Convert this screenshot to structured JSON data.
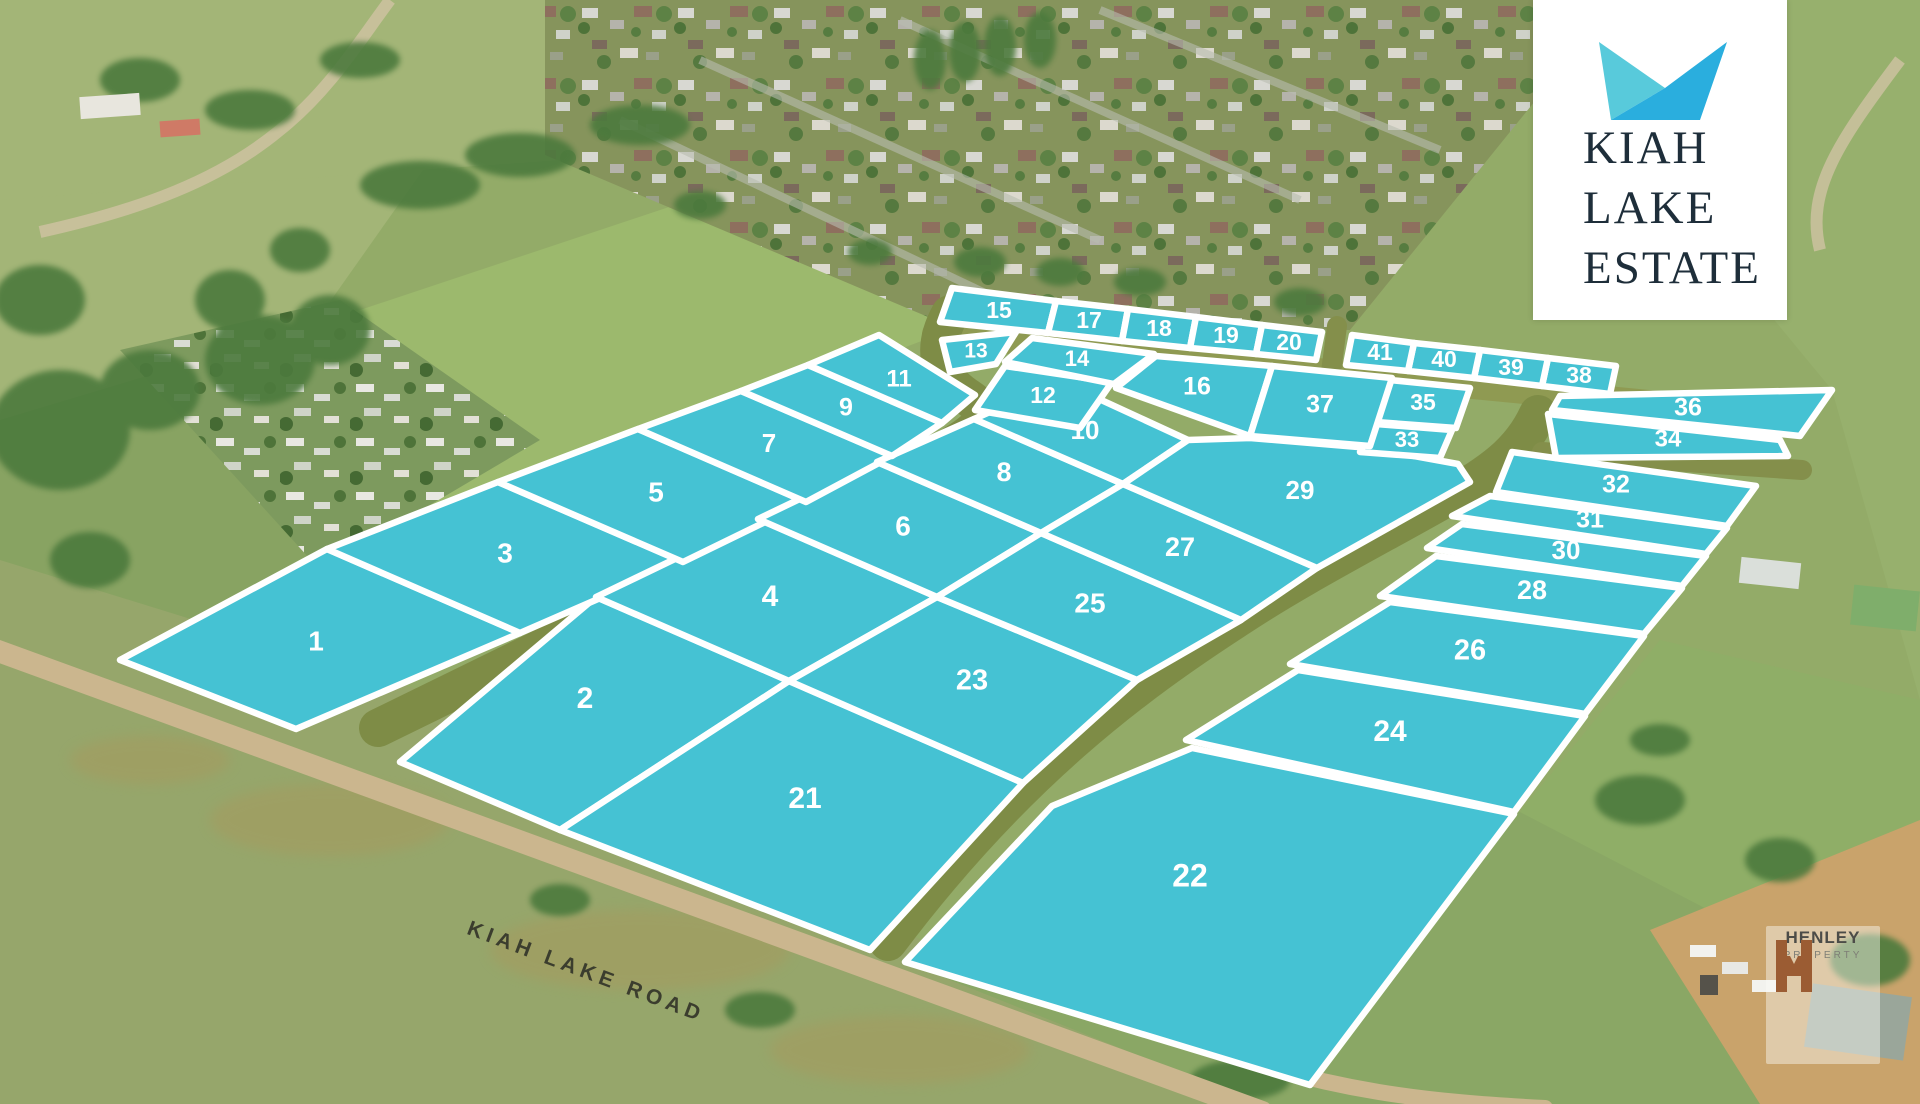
{
  "logo": {
    "line1": "KIAH",
    "line2": "LAKE",
    "line3": "ESTATE"
  },
  "road_label": "KIAH LAKE ROAD",
  "watermark": {
    "monogram": "H",
    "name": "HENLEY",
    "sub": "PROPERTY"
  },
  "colors": {
    "lot_fill": "#45c2d3",
    "lot_border": "#ffffff",
    "road_olive": "#7e8c46",
    "road_olive_light": "#8f9a52",
    "dirt_road": "#cbb68e",
    "logo_teal_light": "#58cadb",
    "logo_blue": "#2aaede",
    "logo_text": "#1e2e3a",
    "watermark_rust": "#9b5c33"
  },
  "map": {
    "lots": [
      {
        "n": "1",
        "points": "120,660 327,549 520,633 296,729",
        "lx": 316,
        "ly": 643,
        "fs": 28
      },
      {
        "n": "2",
        "points": "400,762 596,597 789,681 560,830",
        "lx": 585,
        "ly": 700,
        "fs": 30
      },
      {
        "n": "3",
        "points": "327,549 498,482 683,562 520,633",
        "lx": 505,
        "ly": 555,
        "fs": 28
      },
      {
        "n": "4",
        "points": "596,597 758,519 937,597 789,681",
        "lx": 770,
        "ly": 598,
        "fs": 30
      },
      {
        "n": "5",
        "points": "498,482 638,429 806,502 683,562",
        "lx": 656,
        "ly": 494,
        "fs": 28
      },
      {
        "n": "6",
        "points": "758,519 877,462 1041,533 937,597",
        "lx": 903,
        "ly": 528,
        "fs": 28
      },
      {
        "n": "7",
        "points": "638,429 741,391 892,456 806,502",
        "lx": 769,
        "ly": 445,
        "fs": 26
      },
      {
        "n": "8",
        "points": "877,462 974,419 1123,484 1041,533",
        "lx": 1004,
        "ly": 474,
        "fs": 27
      },
      {
        "n": "9",
        "points": "741,391 808,365 942,423 892,456",
        "lx": 846,
        "ly": 409,
        "fs": 25
      },
      {
        "n": "10",
        "points": "974,419 1060,381 1188,440 1123,484",
        "lx": 1085,
        "ly": 432,
        "fs": 26
      },
      {
        "n": "11",
        "points": "808,365 879,335 975,395 942,423",
        "lx": 899,
        "ly": 380,
        "fs": 24
      },
      {
        "n": "12",
        "points": "975,410 1005,366 1112,382 1080,428",
        "lx": 1043,
        "ly": 397,
        "fs": 23
      },
      {
        "n": "13",
        "points": "942,340 1016,332 996,364 950,372",
        "lx": 976,
        "ly": 352,
        "fs": 21
      },
      {
        "n": "14",
        "points": "1005,362 1032,338 1154,354 1114,384",
        "lx": 1077,
        "ly": 360,
        "fs": 22
      },
      {
        "n": "15",
        "points": "952,288 1056,301 1048,333 940,322",
        "lx": 999,
        "ly": 312,
        "fs": 23
      },
      {
        "n": "16",
        "points": "1156,356 1272,366 1250,436 1116,388",
        "lx": 1197,
        "ly": 388,
        "fs": 25
      },
      {
        "n": "17",
        "points": "1056,301 1128,309 1122,341 1048,333",
        "lx": 1089,
        "ly": 322,
        "fs": 23
      },
      {
        "n": "18",
        "points": "1128,309 1196,317 1190,348 1122,341",
        "lx": 1159,
        "ly": 330,
        "fs": 23
      },
      {
        "n": "19",
        "points": "1196,317 1262,325 1256,354 1190,348",
        "lx": 1226,
        "ly": 337,
        "fs": 23
      },
      {
        "n": "20",
        "points": "1262,325 1322,332 1316,360 1256,354",
        "lx": 1289,
        "ly": 344,
        "fs": 23
      },
      {
        "n": "21",
        "points": "560,830 789,681 1023,783 870,950",
        "lx": 805,
        "ly": 800,
        "fs": 30
      },
      {
        "n": "22",
        "points": "1052,806 1192,748 1514,814 1310,1085 905,962",
        "lx": 1190,
        "ly": 878,
        "fs": 32
      },
      {
        "n": "23",
        "points": "789,681 937,597 1137,680 1023,783",
        "lx": 972,
        "ly": 682,
        "fs": 29
      },
      {
        "n": "24",
        "points": "1298,670 1585,716 1514,812 1186,740",
        "lx": 1390,
        "ly": 733,
        "fs": 30
      },
      {
        "n": "25",
        "points": "937,597 1041,533 1241,620 1137,680",
        "lx": 1090,
        "ly": 605,
        "fs": 28
      },
      {
        "n": "26",
        "points": "1390,602 1644,636 1585,714 1290,664",
        "lx": 1470,
        "ly": 652,
        "fs": 29
      },
      {
        "n": "27",
        "points": "1041,533 1123,484 1317,568 1241,620",
        "lx": 1180,
        "ly": 549,
        "fs": 27
      },
      {
        "n": "28",
        "points": "1436,556 1682,588 1644,634 1380,596",
        "lx": 1532,
        "ly": 592,
        "fs": 27
      },
      {
        "n": "29",
        "points": "1123,484 1188,440 1250,438 1370,448 1458,464 1470,482 1317,568",
        "lx": 1300,
        "ly": 492,
        "fs": 26
      },
      {
        "n": "30",
        "points": "1462,524 1706,556 1682,586 1427,548",
        "lx": 1566,
        "ly": 552,
        "fs": 26
      },
      {
        "n": "31",
        "points": "1490,496 1727,528 1706,554 1452,516",
        "lx": 1590,
        "ly": 521,
        "fs": 25
      },
      {
        "n": "32",
        "points": "1512,452 1756,486 1727,526 1496,492",
        "lx": 1616,
        "ly": 486,
        "fs": 25
      },
      {
        "n": "33",
        "points": "1376,424 1452,430 1440,458 1360,452",
        "lx": 1407,
        "ly": 441,
        "fs": 22
      },
      {
        "n": "34",
        "points": "1548,414 1780,440 1788,456 1556,458",
        "lx": 1668,
        "ly": 440,
        "fs": 24
      },
      {
        "n": "35",
        "points": "1390,380 1470,388 1456,428 1376,422",
        "lx": 1423,
        "ly": 404,
        "fs": 23
      },
      {
        "n": "36",
        "points": "1560,396 1832,390 1800,436 1552,410",
        "lx": 1688,
        "ly": 409,
        "fs": 25
      },
      {
        "n": "37",
        "points": "1272,366 1392,378 1370,446 1250,436",
        "lx": 1320,
        "ly": 406,
        "fs": 25
      },
      {
        "n": "38",
        "points": "1548,358 1616,366 1610,394 1542,386",
        "lx": 1579,
        "ly": 377,
        "fs": 23
      },
      {
        "n": "39",
        "points": "1480,350 1548,358 1542,386 1474,378",
        "lx": 1511,
        "ly": 369,
        "fs": 23
      },
      {
        "n": "40",
        "points": "1414,343 1480,350 1474,378 1408,371",
        "lx": 1444,
        "ly": 361,
        "fs": 23
      },
      {
        "n": "41",
        "points": "1352,335 1414,343 1408,371 1346,365",
        "lx": 1380,
        "ly": 354,
        "fs": 23
      }
    ],
    "roads": [
      {
        "name": "top-road",
        "d": "M 935,334 L 1700,408",
        "w": 26,
        "c": "#8f9a52"
      },
      {
        "name": "road-one",
        "d": "M 950,314 C 932,346 936,376 966,396 C 994,414 988,426 934,456 L 378,728",
        "w": 38,
        "c": "#7e8c46"
      },
      {
        "name": "road-two",
        "d": "M 1538,414 C 1520,454 1488,474 1450,496 C 1376,538 1298,578 1238,618 C 1136,684 1016,772 888,942",
        "w": 38,
        "c": "#7e8c46"
      },
      {
        "name": "road-spur-east",
        "d": "M 1542,452 L 1802,470",
        "w": 20,
        "c": "#848f4b"
      },
      {
        "name": "road-north-entry",
        "d": "M 1337,326 L 1331,372",
        "w": 20,
        "c": "#848f4b"
      },
      {
        "name": "kiah-lake-road",
        "d": "M -10,648 L 1262,1112",
        "w": 22,
        "c": "#cbb68e"
      },
      {
        "name": "dirt-branch",
        "d": "M 1205,1046 C 1330,1092 1430,1102 1545,1108",
        "w": 16,
        "c": "#cbb68e"
      }
    ]
  }
}
